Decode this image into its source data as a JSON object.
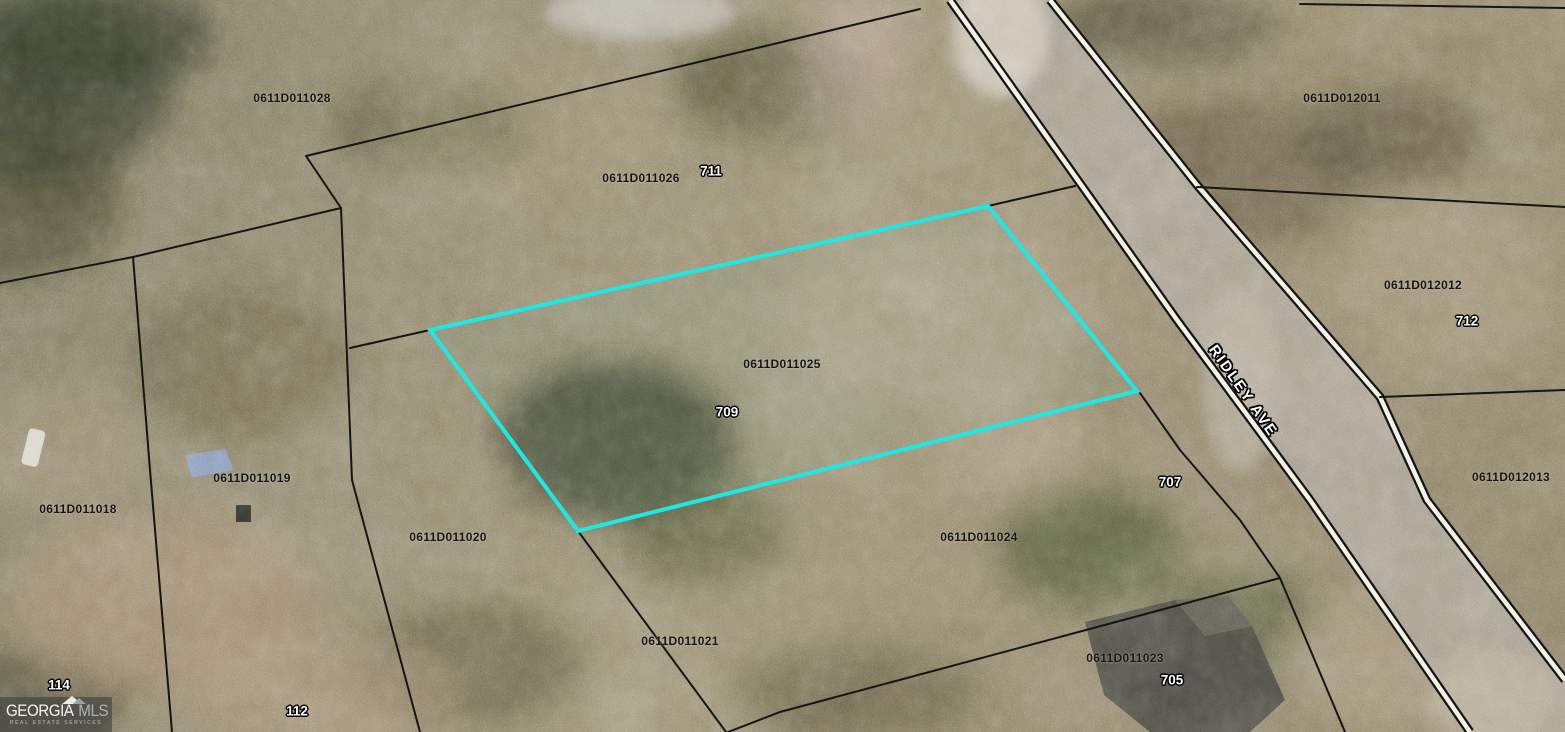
{
  "map": {
    "description": "Aerial plat map with parcel boundaries and selected lot highlight",
    "street": {
      "name": "RIDLEY AVE"
    },
    "selected_parcel": {
      "id": "0611D011025",
      "house_number": "709",
      "outline_color": "#1fe8e4"
    },
    "colors": {
      "highlight": "#1fe8e4",
      "parcel_line": "#151515",
      "road_fill": "#a39a89",
      "road_casing_white": "#f4f1e7",
      "road_casing_black": "#141414"
    },
    "parcels": [
      {
        "id": "0611D011028"
      },
      {
        "id": "0611D011026"
      },
      {
        "id": "0611D011025"
      },
      {
        "id": "0611D012011"
      },
      {
        "id": "0611D012012"
      },
      {
        "id": "0611D012013"
      },
      {
        "id": "0611D011018"
      },
      {
        "id": "0611D011019"
      },
      {
        "id": "0611D011020"
      },
      {
        "id": "0611D011021"
      },
      {
        "id": "0611D011023"
      },
      {
        "id": "0611D011024"
      }
    ],
    "houses": [
      {
        "number": "711"
      },
      {
        "number": "709"
      },
      {
        "number": "712"
      },
      {
        "number": "707"
      },
      {
        "number": "705"
      },
      {
        "number": "114"
      },
      {
        "number": "112"
      }
    ]
  },
  "watermark": {
    "brand_primary": "GEORGIA",
    "brand_secondary": "MLS",
    "tagline": "REAL ESTATE SERVICES"
  }
}
